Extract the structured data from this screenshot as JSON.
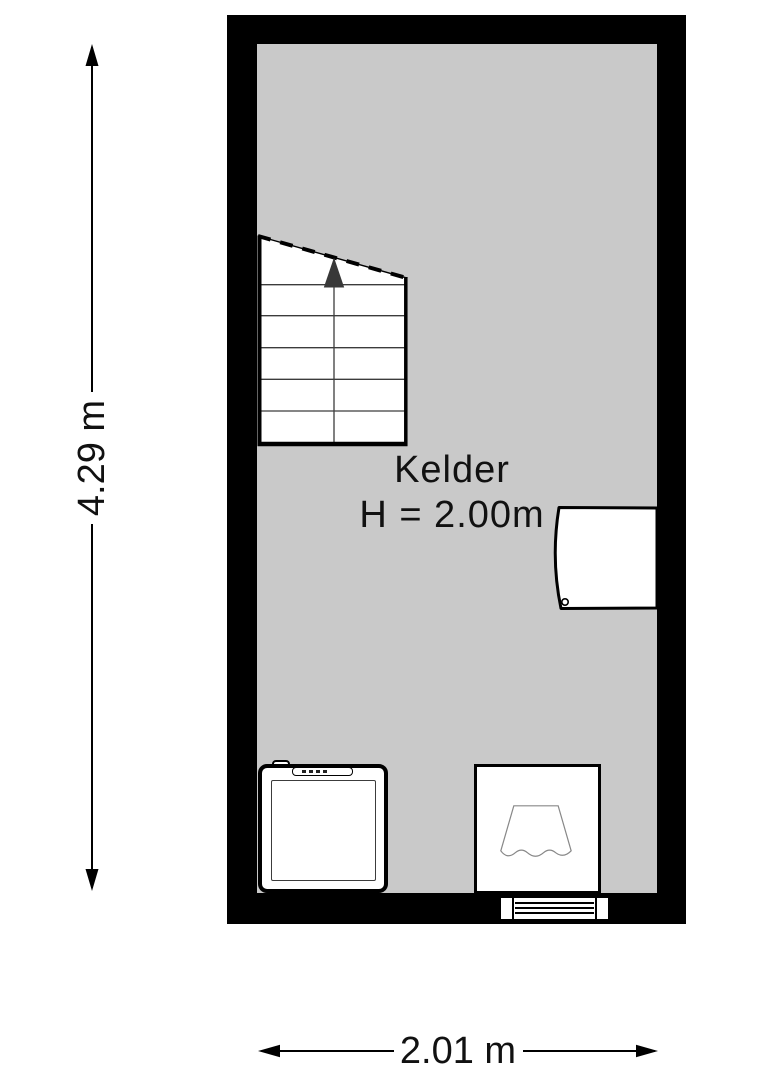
{
  "room": {
    "name": "Kelder",
    "height_label": "H = 2.00m"
  },
  "dimensions": {
    "vertical_label": "4.29 m",
    "horizontal_label": "2.01 m"
  },
  "colors": {
    "page_bg": "#ffffff",
    "wall": "#000000",
    "floor": "#c9c9c9",
    "fixture_fill": "#ffffff",
    "ink": "#111111",
    "stair_line": "#3c3c3c",
    "fixture_line": "#888888"
  },
  "icons": {
    "stairs_direction": "up-arrow-icon",
    "door": "door-leaf-icon",
    "bottom_wall_opening": "louvered-window-icon"
  }
}
